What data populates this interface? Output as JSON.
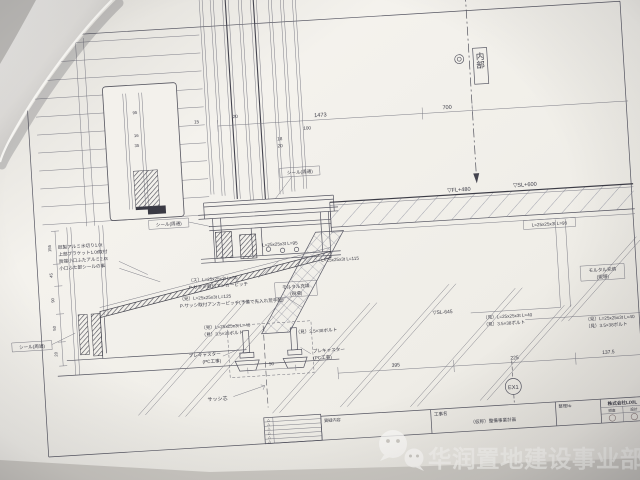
{
  "photo": {
    "watermark": {
      "text": "华润置地建设事业部",
      "icon": "wechat-icon"
    }
  },
  "drawing": {
    "region_labels": {
      "interior": "内部",
      "sash_center": "サッシ芯",
      "grid_tag": "EX1"
    },
    "levels": {
      "fl": "▽FL+480",
      "sl": "▽SL+600",
      "sl_lower": "▽SL-645"
    },
    "seals": {
      "s1": "シール(周通)",
      "s2": "シール(周通)",
      "s3": "シール(周通)"
    },
    "flashing_note": {
      "l1": "既製アルミ水切り1.0t",
      "l2": "上部ブラケット1.0t取付",
      "l3": "両端小口ふたアルミ2.0t",
      "l4": "小口ふた部シールの事"
    },
    "mortar_note": {
      "l1": "モルタル充填",
      "l2": "(現場)"
    },
    "mortar_note_right": {
      "l1": "モルタル充填",
      "l2": "(現場)"
    },
    "angles": {
      "a": "L=25x25x3t L=95",
      "b": "L=25x25x3t L=115",
      "c": "L=25x25x3t L=95"
    },
    "anchor_note_a": {
      "l1": "（ス）L=25x25x3t L=50",
      "l2": "P-サッシ取付アンカーピッチ"
    },
    "anchor_note_b": {
      "l1": "（見）L=25x25x3t L=125",
      "l2": "P-サッシ取付アンカーピッチ(予備で先入れ荒手配)"
    },
    "bolt_note_left": {
      "l1": "（見）L=25x25x3t L=40",
      "l2": "（見）3.5×38ボルト"
    },
    "bolt_note_right": {
      "l1": "（見）3.5×38ボルト"
    },
    "bolt_note_far1": {
      "l1": "（見）L=25x25x3t L=40",
      "l2": "（見）3.5×38ボルト"
    },
    "bolt_note_far2": {
      "l1": "（見）L=25x25x3t L=40",
      "l2": "（見）3.5×38ボルト"
    },
    "precast_left": {
      "l1": "プレキャスター",
      "l2": "(PC工事)"
    },
    "precast_right": {
      "l1": "プレキャスター",
      "l2": "(PC工事)"
    },
    "dims": {
      "d1473": "1473",
      "d700": "700",
      "d395": "395",
      "d225": "225",
      "d137": "137.5",
      "d50": "50",
      "d15": "15",
      "d20a": "20",
      "d100": "100",
      "d18": "18",
      "d20b": "20",
      "d95": "95",
      "d16": "16",
      "d35": "35",
      "v155": "155",
      "v45": "45",
      "v90": "90",
      "v50": "50",
      "v20": "20"
    },
    "title_block": {
      "col_inquiry": "質疑内容",
      "col_project": "工事名",
      "project_name": "（仮称）整備事業計画",
      "col_no": "整理№",
      "company": "株式会社LIXIL",
      "check": "照査",
      "design": "設計",
      "revision_marks": [
        "△",
        "△",
        "△",
        "△",
        "△",
        "△"
      ]
    }
  }
}
